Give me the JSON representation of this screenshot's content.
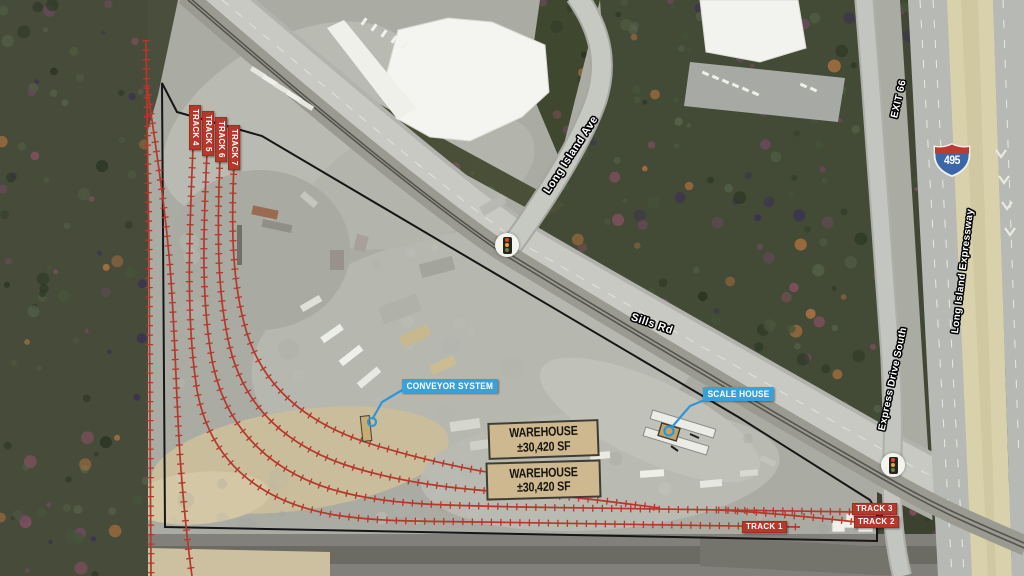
{
  "overlay": {
    "track_labels_vertical": [
      "TRACK 4",
      "TRACK 5",
      "TRACK 6",
      "TRACK 7"
    ],
    "track_labels_horizontal": [
      "TRACK 1",
      "TRACK 2",
      "TRACK 3"
    ],
    "callouts": [
      "CONVEYOR SYSTEM",
      "SCALE HOUSE"
    ],
    "warehouses": [
      {
        "line1": "WAREHOUSE",
        "line2": "±30,420 SF"
      },
      {
        "line1": "WAREHOUSE",
        "line2": "±30,420 SF"
      }
    ]
  },
  "roads": {
    "long_island_ave": "Long Island Ave",
    "sills_rd": "Sills Rd",
    "express_drive_south": "Express Drive South",
    "long_island_expressway": "Long Island Expressway",
    "exit_66": "EXIT 66",
    "interstate_shield": "495"
  },
  "colors": {
    "track_red": "#b5382b",
    "callout_blue": "#3aa0d8",
    "warehouse_tan": "#cdb88f",
    "boundary_black": "#161616"
  }
}
